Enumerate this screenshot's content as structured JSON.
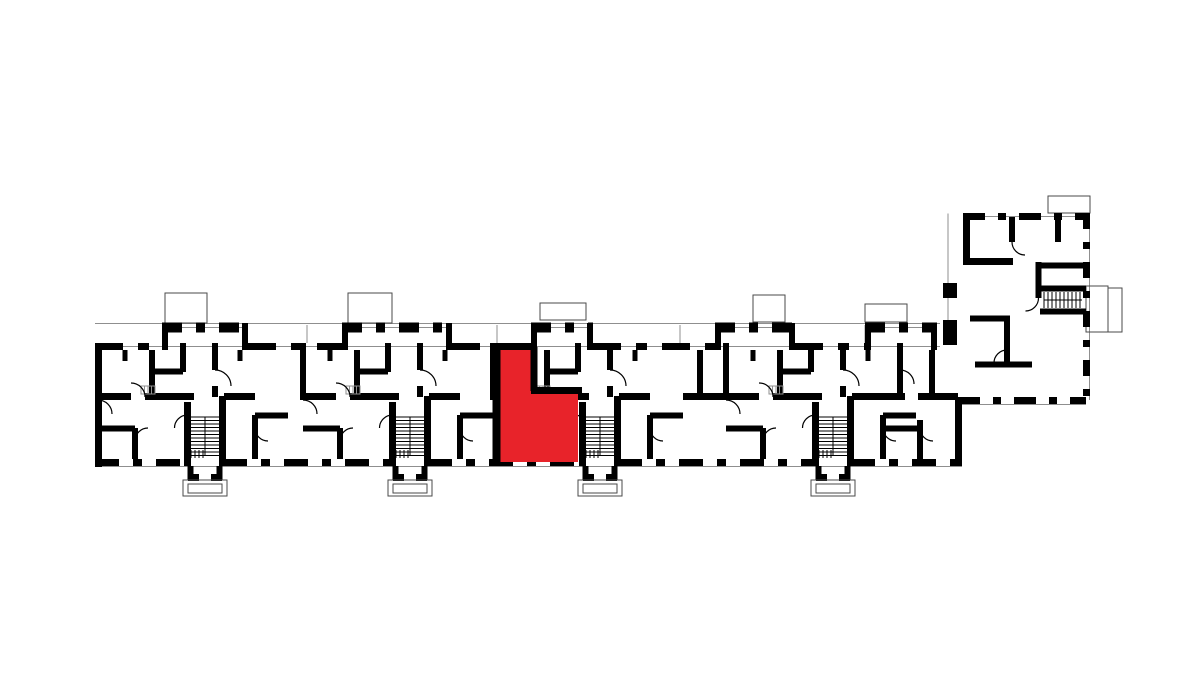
{
  "page": {
    "background_color": "#ffffff",
    "description": "Black-and-white architectural floor plan of a long multi-entrance apartment building with one apartment highlighted in red"
  },
  "plan": {
    "wall_color": "#000000",
    "thin_line_color": "#8f8f8f",
    "highlight_color": "#e8232a",
    "entrance_count": "4",
    "highlighted_unit": {
      "shape": "L-shaped apartment",
      "location": "third entrance section, lower-left of stair core"
    }
  }
}
